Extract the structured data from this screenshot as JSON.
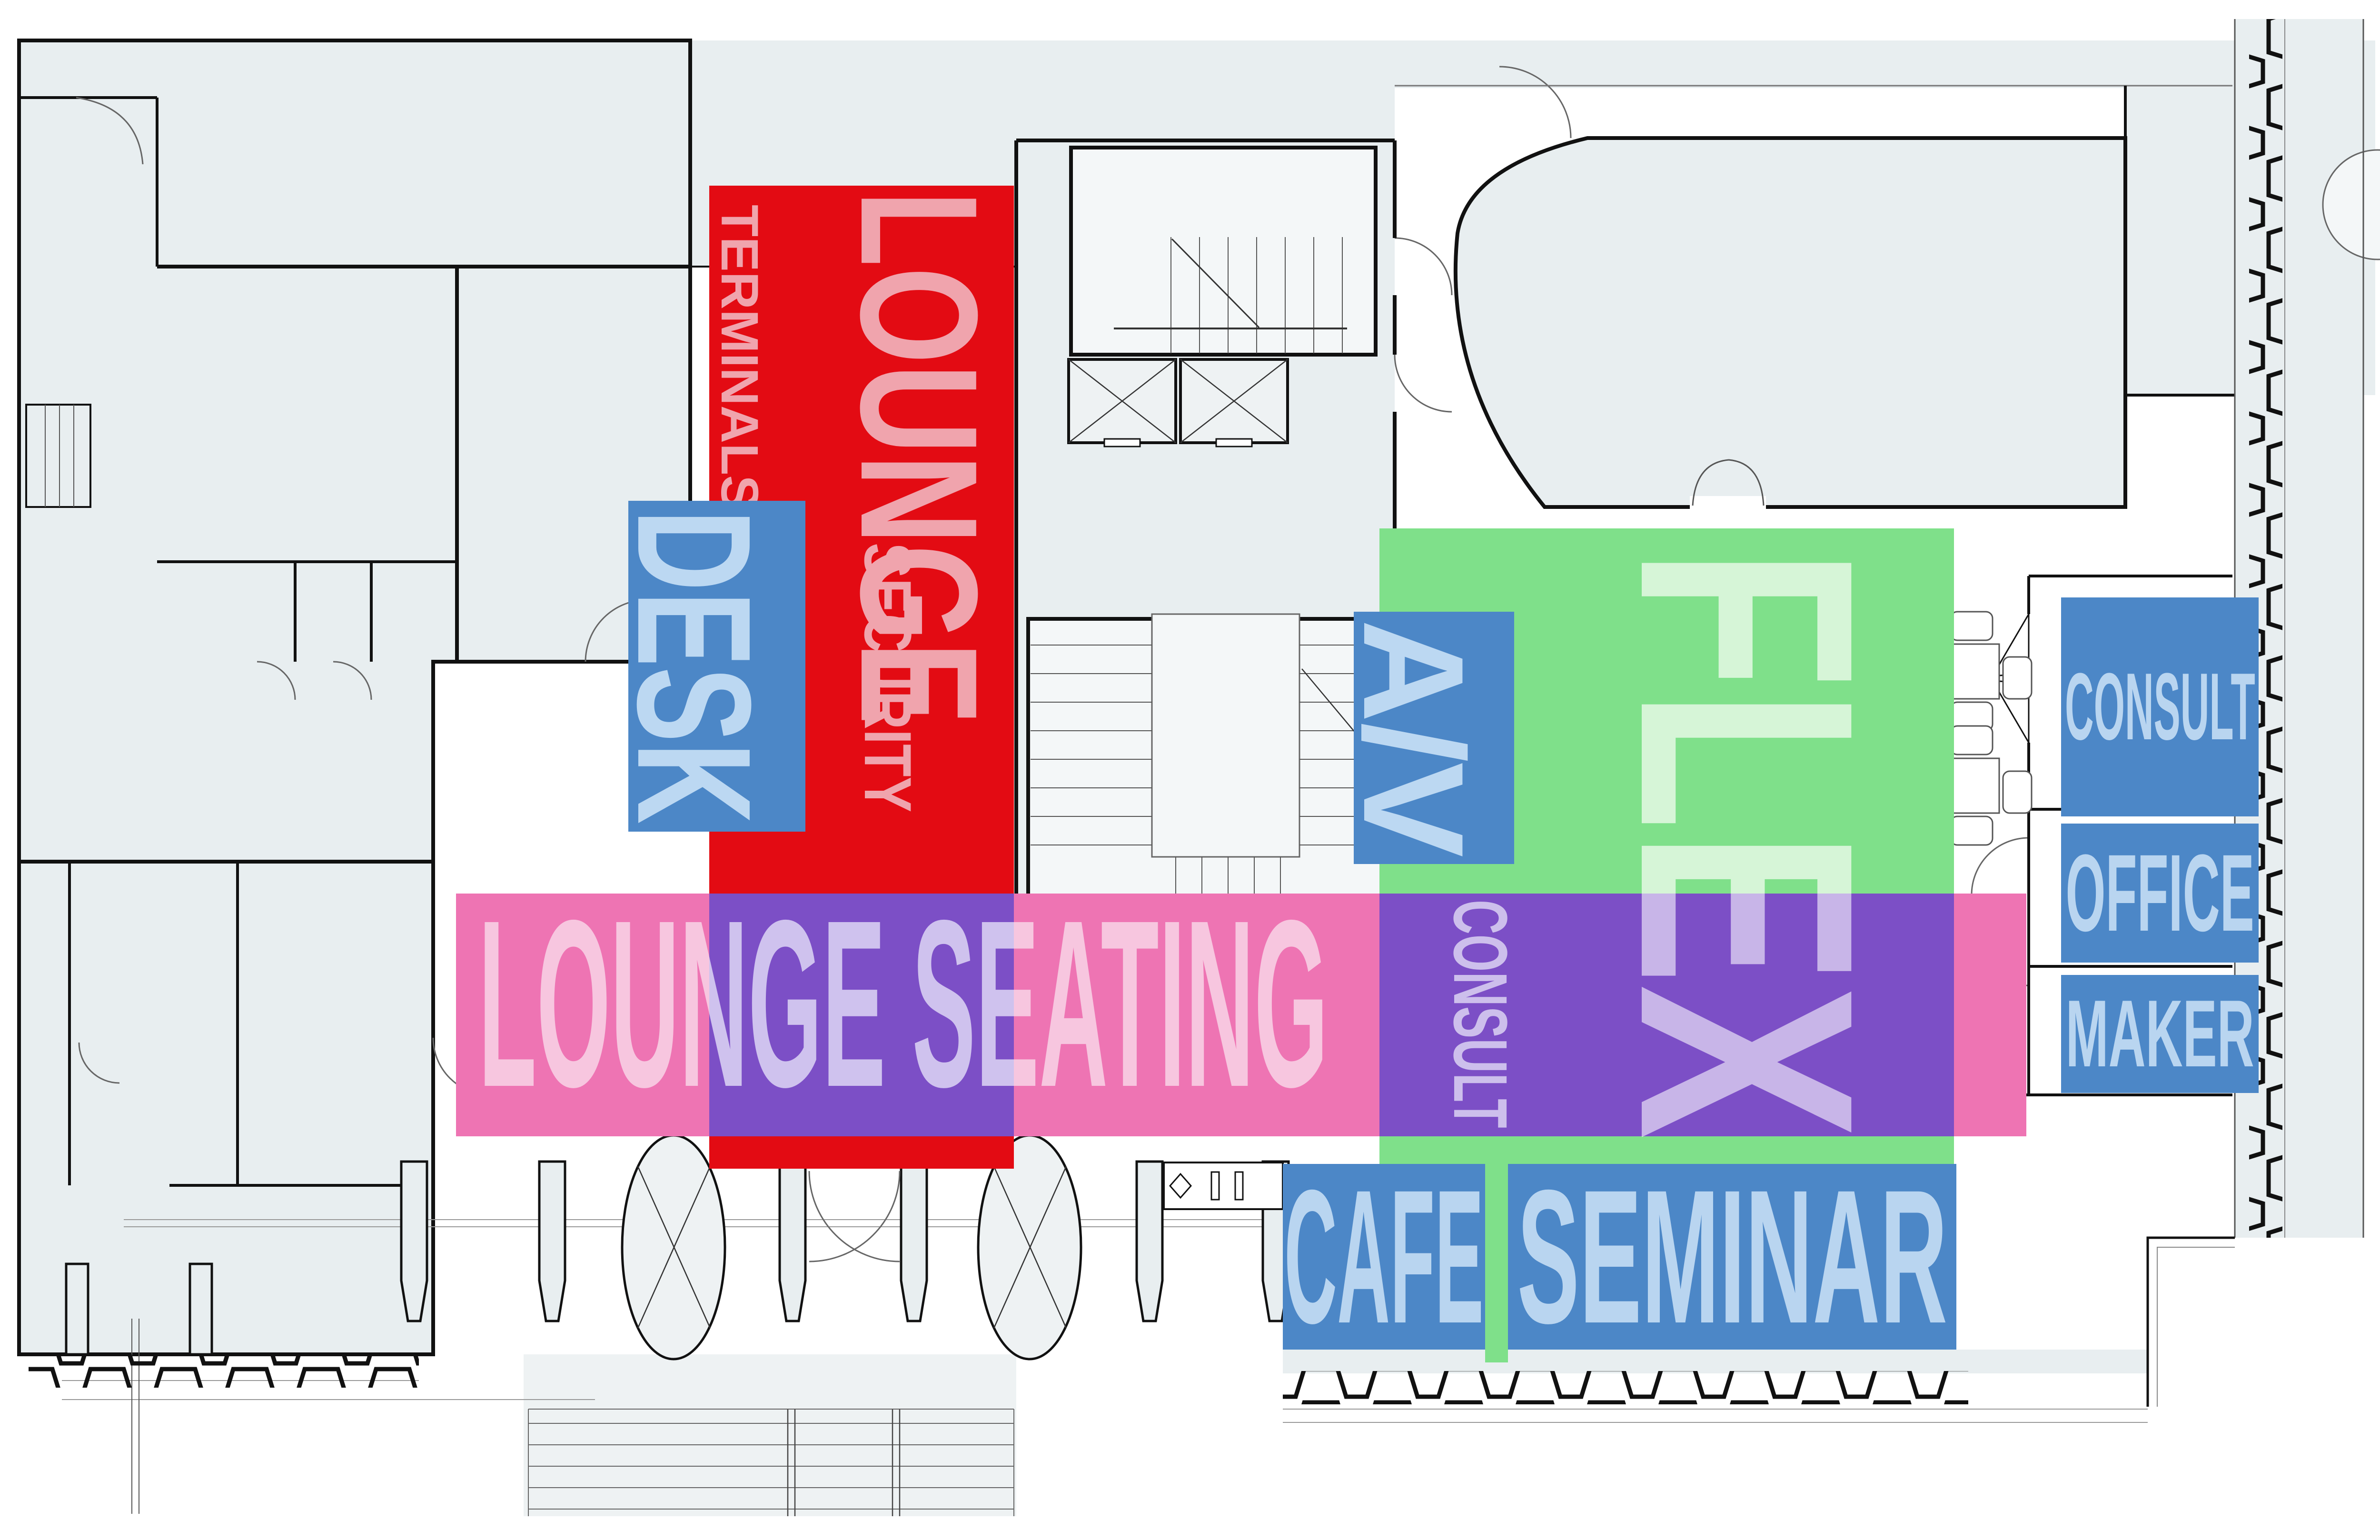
{
  "diagram_title": "Floor plan program diagram",
  "zones": {
    "lounge": {
      "label": "LOUNGE",
      "color": "#e30b13",
      "text_color": "#f0a4ad"
    },
    "security": {
      "label": "SECURITY",
      "color": "#e30b13",
      "text_color": "#f0a4ad"
    },
    "terminals": {
      "label": "TERMINALS",
      "color": "#e30b13",
      "text_color": "#f0a4ad"
    },
    "desk": {
      "label": "DESK",
      "color": "#4c87c7",
      "text_color": "#bcd8f2"
    },
    "av": {
      "label": "A/V",
      "color": "#4c87c7",
      "text_color": "#bcd8f2"
    },
    "flex": {
      "label": "FLEX",
      "color": "#7fe08a",
      "text_color": "#d6f5d7",
      "overlap_text_color": "#c8b5e8"
    },
    "consult_zone": {
      "label": "CONSULT",
      "color": "#7c4fc6",
      "text_color": "#cdbfec"
    },
    "lounge_seating": {
      "label": "LOUNGE SEATING",
      "color": "#ee74b3",
      "text_color": "#f7c6df",
      "overlap_color": "#7c4fc6",
      "overlap_text_color": "#cfc2ee"
    },
    "cafe": {
      "label": "CAFE",
      "color": "#4c87c7",
      "text_color": "#b9d5f0"
    },
    "seminar": {
      "label": "SEMINAR",
      "color": "#4c87c7",
      "text_color": "#b9d5f0"
    },
    "consult_room": {
      "label": "CONSULT",
      "color": "#4c87c7",
      "text_color": "#b9d5f0"
    },
    "office": {
      "label": "OFFICE",
      "color": "#4c87c7",
      "text_color": "#b9d5f0"
    },
    "maker": {
      "label": "MAKER",
      "color": "#4c87c7",
      "text_color": "#b9d5f0"
    }
  },
  "plan": {
    "background": "#ffffff",
    "room_fill": "#e8eef0",
    "wall_color": "#111111"
  }
}
